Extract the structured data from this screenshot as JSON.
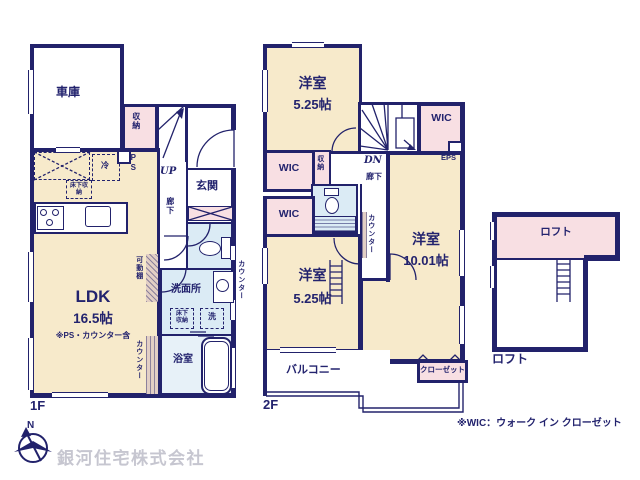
{
  "colors": {
    "wall_navy": "#22226b",
    "room_cream": "#f7eacb",
    "room_pink": "#f8dfe3",
    "room_blue": "#dbebf5",
    "bath_blue": "#e7f1f8",
    "hatch_tan": "#e2cfc5",
    "logo_gray": "#c6c6d0"
  },
  "floor1": {
    "caption": "1F",
    "garage": "車庫",
    "storage": "収納",
    "up": "UP",
    "entrance": "玄関",
    "hallway": "廊下",
    "fridge": "冷",
    "pipe_space": "PS",
    "underfloor_storage": "床下収納",
    "ldk_name": "LDK",
    "ldk_size": "16.5帖",
    "ldk_note": "※PS・カウンター含",
    "movable_shelf": "可動棚",
    "counter": "カウンター",
    "washroom": "洗面所",
    "washer": "洗",
    "bathroom": "浴室"
  },
  "floor2": {
    "caption": "2F",
    "room_top": "洋室",
    "room_top_size": "5.25帖",
    "wic": "WIC",
    "eps": "EPS",
    "down": "DN",
    "closet_small": "収納",
    "hallway": "廊下",
    "counter": "カウンター",
    "room_right": "洋室",
    "room_right_size": "10.01帖",
    "room_bottom": "洋室",
    "room_bottom_size": "5.25帖",
    "balcony": "バルコニー",
    "closet": "クローゼット"
  },
  "loft": {
    "room_label": "ロフト",
    "caption": "ロフト"
  },
  "annotations": {
    "wic_note": "※WIC：ウォーク イン クローゼット",
    "company_name": "銀河住宅株式会社",
    "compass_north": "N"
  }
}
